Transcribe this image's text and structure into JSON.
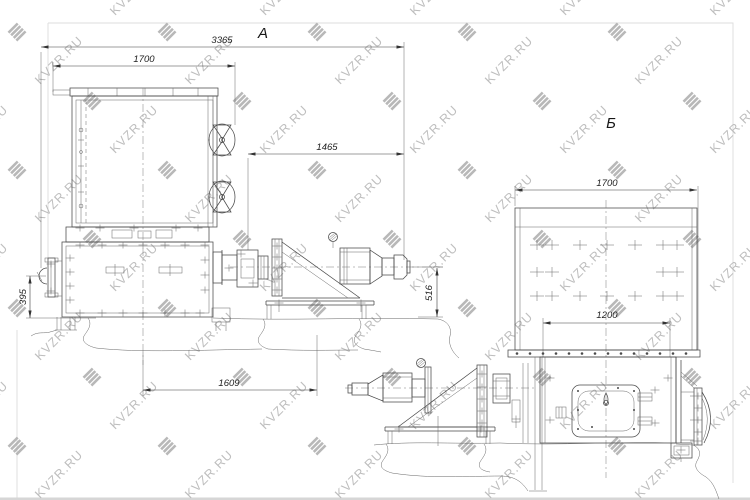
{
  "watermark": {
    "text": "KVZR.RU",
    "text_color": "#b7b7b7",
    "logo_color": "#b1b1b1",
    "logo_icon": "kvzr-stripes-logo"
  },
  "style": {
    "background": "#ffffff",
    "line_color": "#4a4a4a",
    "dim_text_color": "#222222",
    "frame_color": "#dcdcdc"
  },
  "views": {
    "a": {
      "label": "А",
      "dim_overall_width": "3365",
      "dim_top_width": "1700",
      "dim_right_width": "1465",
      "dim_left_height": "395",
      "dim_shaft_height": "516",
      "dim_base_width": "1609"
    },
    "b": {
      "label": "Б",
      "dim_top_width": "1700",
      "dim_inner_width": "1200"
    }
  }
}
